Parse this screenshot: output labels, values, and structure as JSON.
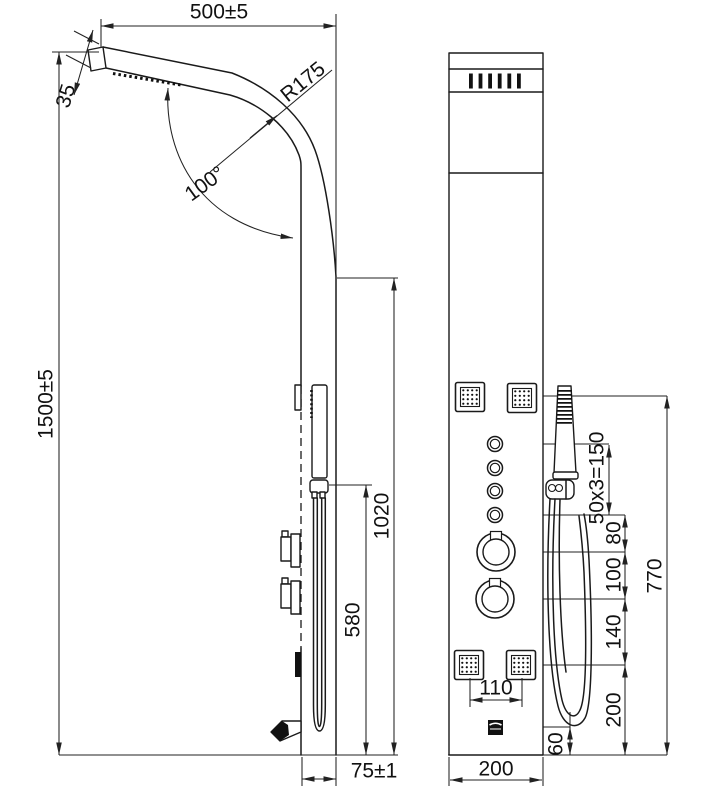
{
  "drawing": {
    "type": "technical dimension drawing, shower panel, side and front views",
    "line_color": "#1a1a1a",
    "background": "#ffffff",
    "left_view": {
      "overall_width": "500±5",
      "head_thickness": "35",
      "bend_radius": "R175",
      "head_angle": "100°",
      "overall_height": "1500±5",
      "hand_shower_top_height": "1020",
      "holder_height": "580",
      "panel_depth": "75±1"
    },
    "right_view": {
      "body_jet_spacing": "50x3=150",
      "gap_jets_to_knob": "80",
      "gap_knob_to_knob": "100",
      "gap_knob_to_lower_jets": "140",
      "gap_lower_jets_to_bottom": "200",
      "controls_zone_height": "770",
      "lower_jet_pair_spacing": "110",
      "spout_height": "60",
      "panel_width": "200"
    }
  }
}
